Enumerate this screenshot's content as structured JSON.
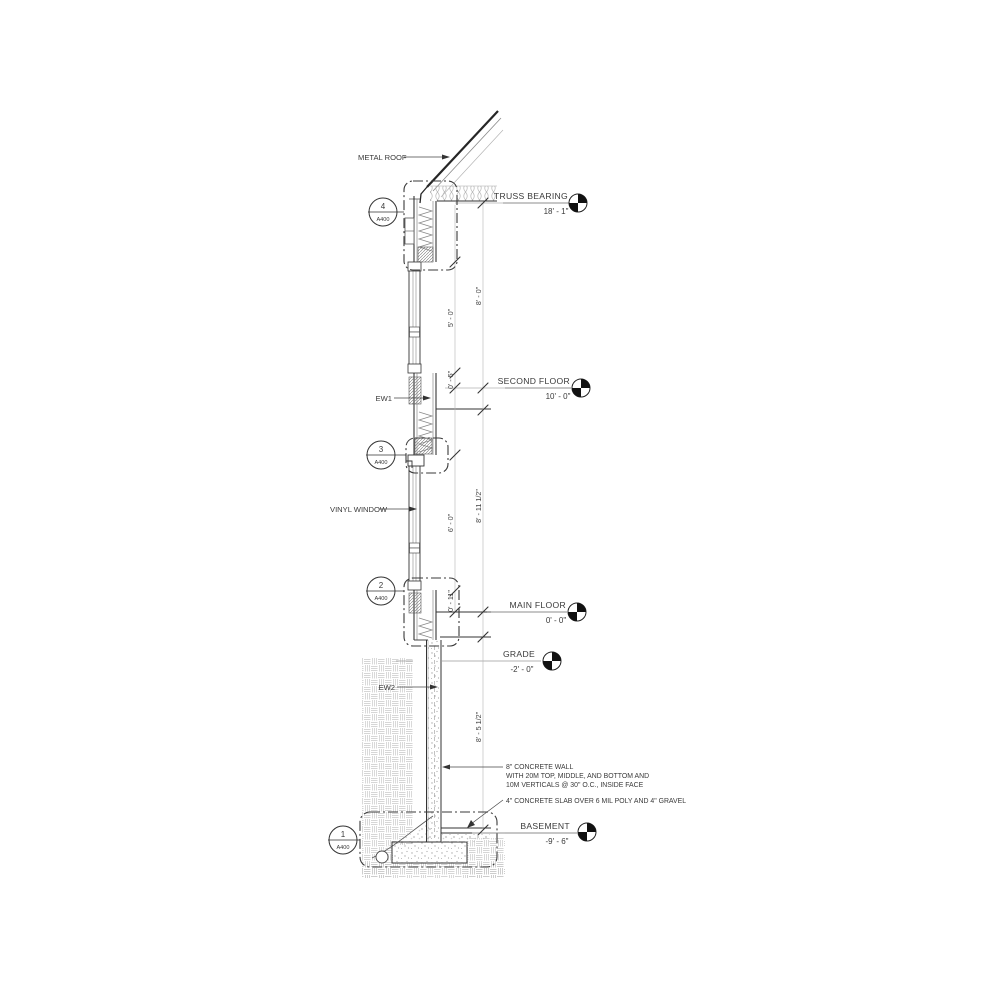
{
  "title": "Wall Section Detail",
  "labels": {
    "metal_roof": "METAL ROOF",
    "ew1": "EW1",
    "vinyl_window": "VINYL WINDOW",
    "ew2": "EW2"
  },
  "levels": [
    {
      "name": "TRUSS BEARING",
      "elevation": "18' - 1\""
    },
    {
      "name": "SECOND FLOOR",
      "elevation": "10' - 0\""
    },
    {
      "name": "MAIN FLOOR",
      "elevation": "0' - 0\""
    },
    {
      "name": "GRADE",
      "elevation": "-2' - 0\""
    },
    {
      "name": "BASEMENT",
      "elevation": "-9' - 6\""
    }
  ],
  "callouts": [
    {
      "number": "4",
      "sheet": "A400"
    },
    {
      "number": "3",
      "sheet": "A400"
    },
    {
      "number": "2",
      "sheet": "A400"
    },
    {
      "number": "1",
      "sheet": "A400"
    }
  ],
  "dims": [
    "8' - 0\"",
    "5' - 0\"",
    "0' - 5\"",
    "8' - 11 1/2\"",
    "6' - 0\"",
    "0' - 11\"",
    "8' - 5 1/2\""
  ],
  "notes": {
    "wall_line1": "8\" CONCRETE WALL",
    "wall_line2": "WITH 20M TOP, MIDDLE, AND BOTTOM AND",
    "wall_line3": "10M VERTICALS @ 30\" O.C.,  INSIDE FACE",
    "slab": "4\" CONCRETE SLAB OVER 6 MIL POLY AND 4\" GRAVEL"
  },
  "colors": {
    "line": "#2b2b2b",
    "grey_line": "#9a9a9a",
    "hatch": "#c9c9c9"
  }
}
